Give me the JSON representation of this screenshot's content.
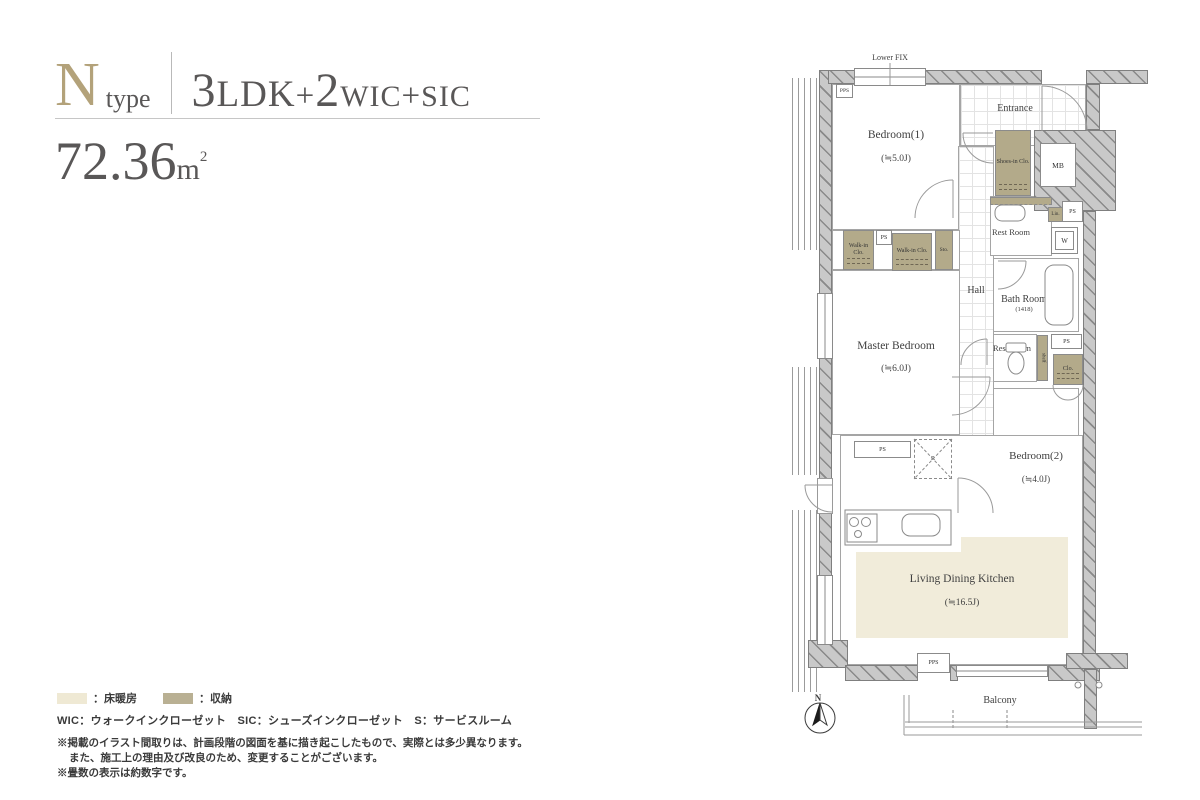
{
  "header": {
    "type_letter": "N",
    "type_word": "type",
    "layout": {
      "n1": "3",
      "u1": "LDK",
      "p1": "+",
      "n2": "2",
      "u2": "WIC",
      "p2": "+",
      "u3": "SIC"
    },
    "area_value": "72.36",
    "area_unit_m": "m",
    "area_unit_sup": "2"
  },
  "plan": {
    "labels": {
      "lower_fix": "Lower FIX",
      "entrance": "Entrance",
      "bedroom1": "Bedroom(1)",
      "bedroom1_size": "(≒5.0J)",
      "shoes_in_clo": "Shoes-in Clo.",
      "mb": "MB",
      "ps": "PS",
      "pps": "PPS",
      "lin": "Lin.",
      "w": "W",
      "rest_room": "Rest Room",
      "walk_in_clo": "Walk-in Clo.",
      "sto": "Sto.",
      "hall": "Hall",
      "bath_room": "Bath Room",
      "bath_size": "(1418)",
      "master_bedroom": "Master Bedroom",
      "master_size": "(≒6.0J)",
      "shelf": "shelf",
      "clo": "Clo.",
      "bedroom2": "Bedroom(2)",
      "bedroom2_size": "(≒4.0J)",
      "r": "R",
      "ldk": "Living Dining Kitchen",
      "ldk_size": "(≒16.5J)",
      "balcony": "Balcony",
      "north": "N"
    },
    "colors": {
      "storage": "#b3aa8a",
      "floor_heating": "#f1ecda",
      "wall": "#c9c9c9",
      "accent": "#b3a27a"
    }
  },
  "legend": {
    "floor_heating_label": "：床暖房",
    "storage_label": "：収納",
    "abbreviations": "WIC：ウォークインクローゼット　SIC：シューズインクローゼット　S：サービスルーム",
    "notes": [
      "※掲載のイラスト間取りは、計画段階の図面を基に描き起こしたもので、実際とは多少異なります。",
      "また、施工上の理由及び改良のため、変更することがございます。",
      "※畳数の表示は約数字です。"
    ]
  }
}
